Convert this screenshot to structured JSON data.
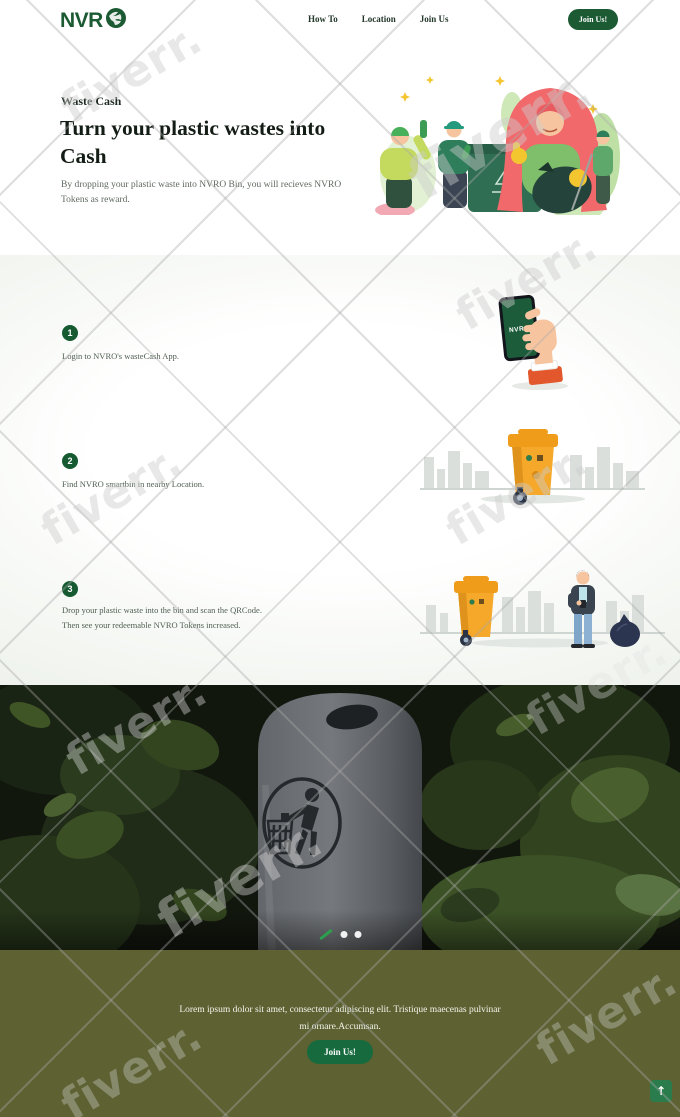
{
  "brand": {
    "name": "NVR",
    "icon": "globe-leaf-icon"
  },
  "header": {
    "nav": [
      {
        "label": "How To"
      },
      {
        "label": "Location"
      },
      {
        "label": "Join Us"
      }
    ],
    "cta": "Join Us!"
  },
  "hero": {
    "eyebrow": "Waste Cash",
    "title_lines": [
      "Turn your plastic wastes into",
      "Cash"
    ],
    "description": "By dropping your plastic waste into NVRO Bin, you will recieves NVRO Tokens as reward.",
    "illustration": "people-collecting-plastic-waste"
  },
  "how_to": {
    "steps": [
      {
        "number": "1",
        "lines": [
          "Login to NVRO's wasteCash App.",
          ""
        ],
        "illustration": "hand-holding-nvro-phone"
      },
      {
        "number": "2",
        "lines": [
          "Find NVRO smartbin in nearby Location.",
          ""
        ],
        "illustration": "smart-bin-in-city"
      },
      {
        "number": "3",
        "lines": [
          "Drop your plastic waste into the bin and scan the QRCode.",
          "Then see your redeemable NVRO Tokens increased."
        ],
        "illustration": "smart-bin-person-trash-bag"
      }
    ],
    "phone_screen_label": "NVRO"
  },
  "gallery": {
    "photo": "outdoor-litter-bin-in-forest",
    "indicators": [
      {
        "state": "active"
      },
      {
        "state": "inactive"
      },
      {
        "state": "inactive"
      }
    ]
  },
  "footer": {
    "text_lines": [
      "Lorem ipsum dolor sit amet, consectetur adipiscing elit. Tristique maecenas pulvinar",
      "mi ornare.Accumsan."
    ],
    "cta": "Join Us!",
    "scroll_top_icon": "↑"
  },
  "watermark": {
    "text": "fiverr."
  },
  "colors": {
    "brand_green": "#1b5a33",
    "step_badge_green": "#155a31",
    "cta_green": "#17693e",
    "footer_olive": "#5e6233",
    "bin_orange": "#f5a829",
    "hair_red": "#f2696b",
    "indicator_green": "#2e9e4f"
  }
}
